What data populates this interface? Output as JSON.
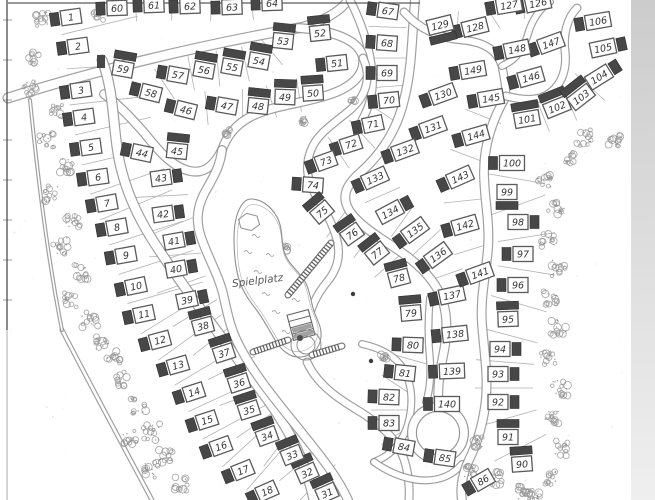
{
  "map": {
    "playground_label": "Spielplatz",
    "colors": {
      "ink": "#8f8f8f",
      "border": "#3d3d3d",
      "building": "#474747",
      "box_border": "#5a5a5a",
      "number": "#333333",
      "parcel_line": "#b3b3b3",
      "tree": "#929292",
      "edge_strip_top": "#cccccc",
      "edge_strip_bottom": "#efefef",
      "label_text": "#5a5a5a"
    },
    "lots": [
      [
        1,
        71,
        17,
        -8,
        "l"
      ],
      [
        2,
        78,
        46,
        -8,
        "l"
      ],
      [
        3,
        81,
        90,
        -8,
        "l"
      ],
      [
        4,
        84,
        117,
        -8,
        "l"
      ],
      [
        5,
        91,
        147,
        -8,
        "l"
      ],
      [
        6,
        98,
        177,
        -8,
        "l"
      ],
      [
        7,
        107,
        203,
        -10,
        "l"
      ],
      [
        8,
        117,
        227,
        -10,
        "l"
      ],
      [
        9,
        126,
        255,
        -10,
        "l"
      ],
      [
        10,
        136,
        286,
        -12,
        "l"
      ],
      [
        11,
        144,
        314,
        -12,
        "l"
      ],
      [
        12,
        160,
        340,
        -15,
        "l"
      ],
      [
        13,
        178,
        365,
        -16,
        "l"
      ],
      [
        14,
        194,
        392,
        -18,
        "l"
      ],
      [
        15,
        207,
        420,
        -18,
        "l"
      ],
      [
        16,
        221,
        446,
        -20,
        "l"
      ],
      [
        17,
        243,
        470,
        -22,
        "l"
      ],
      [
        18,
        267,
        491,
        -24,
        "l"
      ],
      [
        31,
        327,
        493,
        -24,
        "t"
      ],
      [
        32,
        307,
        473,
        -24,
        "t"
      ],
      [
        33,
        292,
        455,
        -22,
        "t"
      ],
      [
        34,
        267,
        436,
        -20,
        "t"
      ],
      [
        35,
        249,
        410,
        -18,
        "t"
      ],
      [
        36,
        239,
        383,
        -18,
        "t"
      ],
      [
        37,
        224,
        353,
        -18,
        "t"
      ],
      [
        38,
        203,
        326,
        -15,
        "t"
      ],
      [
        39,
        187,
        300,
        -12,
        "r"
      ],
      [
        40,
        176,
        269,
        -10,
        "r"
      ],
      [
        41,
        174,
        241,
        -10,
        "r"
      ],
      [
        42,
        163,
        214,
        -8,
        "r"
      ],
      [
        43,
        161,
        178,
        -8,
        "r"
      ],
      [
        44,
        142,
        153,
        12,
        "l"
      ],
      [
        45,
        177,
        151,
        6,
        "t"
      ],
      [
        46,
        186,
        110,
        14,
        "l"
      ],
      [
        47,
        227,
        106,
        10,
        "l"
      ],
      [
        48,
        258,
        106,
        6,
        "t"
      ],
      [
        49,
        285,
        97,
        2,
        "t"
      ],
      [
        50,
        313,
        93,
        -4,
        "t"
      ],
      [
        51,
        337,
        63,
        -6,
        "l"
      ],
      [
        52,
        320,
        33,
        -6,
        "t"
      ],
      [
        53,
        283,
        41,
        6,
        "t"
      ],
      [
        54,
        259,
        61,
        10,
        "t"
      ],
      [
        55,
        232,
        67,
        10,
        "t"
      ],
      [
        56,
        204,
        70,
        10,
        "t"
      ],
      [
        57,
        178,
        75,
        10,
        "l"
      ],
      [
        58,
        151,
        93,
        14,
        "l"
      ],
      [
        59,
        123,
        69,
        10,
        "t"
      ],
      [
        60,
        117,
        8,
        -2,
        "l"
      ],
      [
        61,
        154,
        5,
        -2,
        "l"
      ],
      [
        62,
        190,
        6,
        -2,
        "l"
      ],
      [
        63,
        232,
        7,
        -2,
        "l"
      ],
      [
        64,
        272,
        3,
        -2,
        "l"
      ],
      [
        67,
        388,
        11,
        8,
        "l"
      ],
      [
        68,
        387,
        43,
        4,
        "l"
      ],
      [
        69,
        387,
        73,
        0,
        "l"
      ],
      [
        70,
        389,
        100,
        -6,
        "l"
      ],
      [
        71,
        373,
        124,
        -12,
        "l"
      ],
      [
        72,
        351,
        144,
        -18,
        "l"
      ],
      [
        73,
        326,
        161,
        -20,
        "l"
      ],
      [
        74,
        313,
        185,
        4,
        "l"
      ],
      [
        75,
        322,
        212,
        -40,
        "t"
      ],
      [
        76,
        352,
        234,
        -35,
        "t"
      ],
      [
        77,
        377,
        253,
        -38,
        "t"
      ],
      [
        78,
        399,
        278,
        -15,
        "t"
      ],
      [
        79,
        411,
        313,
        -5,
        "t"
      ],
      [
        80,
        413,
        345,
        2,
        "l"
      ],
      [
        81,
        405,
        373,
        6,
        "l"
      ],
      [
        82,
        389,
        397,
        2,
        "l"
      ],
      [
        83,
        389,
        423,
        0,
        "l"
      ],
      [
        84,
        404,
        447,
        10,
        "l"
      ],
      [
        85,
        445,
        458,
        8,
        "l"
      ],
      [
        86,
        483,
        480,
        -30,
        "l"
      ],
      [
        90,
        522,
        464,
        -4,
        "t"
      ],
      [
        91,
        508,
        437,
        0,
        "t"
      ],
      [
        92,
        498,
        402,
        0,
        "r"
      ],
      [
        93,
        498,
        374,
        0,
        "r"
      ],
      [
        94,
        500,
        349,
        0,
        "r"
      ],
      [
        95,
        508,
        319,
        -2,
        "t"
      ],
      [
        96,
        518,
        285,
        0,
        "l"
      ],
      [
        97,
        523,
        254,
        0,
        "l"
      ],
      [
        98,
        518,
        222,
        0,
        "r"
      ],
      [
        99,
        507,
        192,
        0,
        "b"
      ],
      [
        100,
        512,
        163,
        0,
        "l"
      ],
      [
        101,
        527,
        119,
        -10,
        "t"
      ],
      [
        102,
        557,
        107,
        -22,
        "t"
      ],
      [
        103,
        581,
        97,
        -38,
        "t"
      ],
      [
        104,
        599,
        77,
        -32,
        "r"
      ],
      [
        105,
        603,
        48,
        -12,
        "r"
      ],
      [
        106,
        598,
        21,
        -10,
        "l"
      ],
      [
        126,
        538,
        3,
        -12,
        "l"
      ],
      [
        127,
        509,
        5,
        -10,
        "l"
      ],
      [
        128,
        475,
        27,
        -14,
        "l"
      ],
      [
        129,
        440,
        25,
        -14,
        "b"
      ],
      [
        130,
        443,
        94,
        -20,
        "l"
      ],
      [
        131,
        433,
        127,
        -20,
        "l"
      ],
      [
        132,
        405,
        150,
        -20,
        "l"
      ],
      [
        133,
        375,
        178,
        -24,
        "l"
      ],
      [
        134,
        390,
        212,
        -28,
        "r"
      ],
      [
        135,
        415,
        230,
        -36,
        "l"
      ],
      [
        136,
        438,
        255,
        -36,
        "l"
      ],
      [
        137,
        452,
        295,
        -12,
        "l"
      ],
      [
        138,
        455,
        334,
        -6,
        "l"
      ],
      [
        139,
        452,
        371,
        -2,
        "l"
      ],
      [
        140,
        447,
        404,
        0,
        "l"
      ],
      [
        141,
        480,
        273,
        -20,
        "l"
      ],
      [
        142,
        465,
        225,
        -16,
        "l"
      ],
      [
        143,
        460,
        177,
        -24,
        "l"
      ],
      [
        144,
        476,
        135,
        -16,
        "l"
      ],
      [
        145,
        491,
        98,
        -10,
        "l"
      ],
      [
        146,
        531,
        77,
        -16,
        "l"
      ],
      [
        147,
        551,
        43,
        -20,
        "l"
      ],
      [
        148,
        517,
        49,
        -12,
        "l"
      ],
      [
        149,
        473,
        70,
        -10,
        "l"
      ]
    ],
    "roads": [
      {
        "d": "M 8 98 C 90 72 200 45 298 28",
        "w": 11
      },
      {
        "d": "M 298 28 C 322 22 340 12 348 0",
        "w": 10
      },
      {
        "d": "M 350 0 C 362 24 370 48 372 72 C 374 90 370 106 362 120",
        "w": 9
      },
      {
        "d": "M 298 28 C 332 30 360 40 363 58 C 365 76 350 88 328 95 C 300 104 272 106 252 116 C 234 125 226 138 222 150 C 214 166 204 174 190 171 C 172 167 158 150 146 135 C 134 121 118 104 104 94",
        "w": 10
      },
      {
        "d": "M 102 60 C 116 96 112 136 122 172 C 134 218 160 252 184 286 C 208 320 236 356 262 392 C 286 424 304 456 314 500",
        "w": 11
      },
      {
        "d": "M 222 150 C 220 168 211 181 204 194 C 196 210 196 224 202 240 C 210 262 220 278 224 298 C 228 316 231 331 241 349 C 257 379 283 409 306 438 C 322 458 338 478 348 500",
        "w": 10
      },
      {
        "d": "M 363 58 C 372 78 366 96 350 110 C 333 124 317 134 311 150 C 305 165 307 180 315 194 C 325 210 333 224 337 240 C 341 256 337 270 327 282 C 317 294 310 308 307 326",
        "w": 9
      },
      {
        "d": "M 415 0 C 412 35 412 70 404 100 C 397 130 381 154 361 172 C 346 185 341 196 349 210 C 359 226 381 238 401 252 C 421 266 437 282 443 302 C 448 318 447 338 443 356 C 439 376 437 392 439 408",
        "w": 10
      },
      {
        "d": "M 307 362 C 316 382 334 396 354 408 C 374 420 390 432 399 448 C 407 462 410 482 409 500",
        "w": 9
      },
      {
        "d": "M 362 344 C 380 348 396 356 404 370 C 413 386 413 406 408 424 C 402 444 390 456 374 462",
        "w": 8
      },
      {
        "d": "M 374 462 C 388 472 402 478 418 480 C 438 482 452 476 462 464",
        "w": 8
      },
      {
        "d": "M 506 96 C 492 120 484 146 484 172 C 484 198 490 222 488 248 C 486 274 480 298 482 324 C 484 350 488 374 486 398 C 484 420 478 442 468 462 C 462 476 460 488 462 500",
        "w": 10
      },
      {
        "d": "M 404 12 C 420 30 440 38 462 40 C 486 42 498 52 502 66 C 504 76 506 88 506 96",
        "w": 9
      },
      {
        "d": "M 502 66 C 516 60 524 48 528 34 C 532 20 540 8 550 2",
        "w": 8
      },
      {
        "d": "M 506 96 C 522 100 538 102 550 93 C 563 83 567 67 565 51 C 563 35 567 18 577 8",
        "w": 9
      },
      {
        "d": "M 430 298 C 428 318 428 340 430 360 C 431 376 430 390 426 402",
        "w": 8
      },
      {
        "d": "M 62 330 C 92 388 122 444 152 500",
        "w": 5
      },
      {
        "d": "M 30 100 C 38 180 48 260 62 330",
        "w": 4
      }
    ],
    "borders": [
      {
        "d": "M 8 3 L 420 3",
        "sw": 1.3,
        "op": 0.85
      },
      {
        "d": "M 7 0 L 7 330",
        "sw": 1.3,
        "op": 0.9
      },
      {
        "d": "M 7 330 L 7 500",
        "sw": 1.1,
        "op": 0.4
      },
      {
        "d": "M 632 0 L 632 256",
        "sw": 1.6,
        "op": 0.95
      }
    ],
    "border_ticks": [
      20,
      60,
      100,
      140,
      180,
      220,
      260,
      300
    ],
    "trees": [
      [
        40,
        18,
        8
      ],
      [
        98,
        13,
        7
      ],
      [
        34,
        58,
        6
      ],
      [
        30,
        88,
        7
      ],
      [
        58,
        112,
        7
      ],
      [
        46,
        140,
        8
      ],
      [
        66,
        166,
        7
      ],
      [
        52,
        194,
        8
      ],
      [
        73,
        220,
        7
      ],
      [
        60,
        246,
        8
      ],
      [
        82,
        272,
        8
      ],
      [
        70,
        300,
        7
      ],
      [
        90,
        320,
        8
      ],
      [
        102,
        342,
        7
      ],
      [
        114,
        356,
        7
      ],
      [
        124,
        380,
        8
      ],
      [
        138,
        406,
        8
      ],
      [
        152,
        432,
        9
      ],
      [
        166,
        456,
        8
      ],
      [
        130,
        436,
        8
      ],
      [
        150,
        470,
        8
      ],
      [
        180,
        484,
        7
      ],
      [
        545,
        182,
        7
      ],
      [
        556,
        210,
        8
      ],
      [
        547,
        240,
        7
      ],
      [
        559,
        268,
        8
      ],
      [
        550,
        298,
        7
      ],
      [
        558,
        328,
        8
      ],
      [
        548,
        358,
        7
      ],
      [
        560,
        388,
        8
      ],
      [
        552,
        418,
        7
      ],
      [
        561,
        448,
        8
      ],
      [
        550,
        478,
        7
      ],
      [
        534,
        496,
        6
      ],
      [
        585,
        138,
        8
      ],
      [
        614,
        142,
        7
      ],
      [
        644,
        130,
        6
      ],
      [
        568,
        158,
        6
      ],
      [
        498,
        478,
        8
      ],
      [
        522,
        492,
        7
      ],
      [
        476,
        442,
        6
      ],
      [
        470,
        472,
        6
      ],
      [
        302,
        120,
        4
      ],
      [
        228,
        132,
        3
      ],
      [
        385,
        357,
        4
      ],
      [
        352,
        100,
        3
      ],
      [
        260,
        212,
        3
      ],
      [
        285,
        248,
        3
      ]
    ],
    "parcel_groups": [
      {
        "nums": [
          1,
          2,
          3,
          4,
          5,
          6,
          7,
          8,
          9,
          10,
          11,
          12,
          13,
          14,
          15,
          16,
          17,
          18
        ],
        "len": 78,
        "off": -26
      },
      {
        "nums": [
          43,
          42,
          41,
          40,
          39,
          38,
          37,
          36,
          35,
          34,
          33,
          32,
          31
        ],
        "len": 52,
        "off": 0
      },
      {
        "nums": [
          60,
          61,
          62,
          63,
          64
        ],
        "len": 30,
        "off": 0
      },
      {
        "nums": [
          67,
          68,
          69,
          70,
          71,
          72,
          73
        ],
        "len": 38,
        "off": 0
      },
      {
        "nums": [
          53,
          54,
          55,
          56,
          57,
          58
        ],
        "len": 36,
        "off": 0
      },
      {
        "nums": [
          46,
          47,
          48,
          49,
          50
        ],
        "len": 34,
        "off": 0
      },
      {
        "nums": [
          75,
          76,
          77,
          78
        ],
        "len": 36,
        "off": 0
      },
      {
        "nums": [
          90,
          91,
          92,
          93,
          94,
          95,
          96,
          97,
          98,
          99,
          100
        ],
        "len": 58,
        "off": 6
      },
      {
        "nums": [
          101,
          102,
          103,
          104
        ],
        "len": 40,
        "off": 0
      },
      {
        "nums": [
          133,
          134,
          135,
          136,
          137
        ],
        "len": 38,
        "off": 0
      },
      {
        "nums": [
          141,
          142,
          143,
          144,
          145
        ],
        "len": 38,
        "off": 0
      },
      {
        "nums": [
          80,
          81,
          82,
          83,
          84
        ],
        "len": 36,
        "off": 0
      },
      {
        "nums": [
          126,
          127,
          128,
          129
        ],
        "len": 30,
        "off": 0
      }
    ],
    "features": {
      "island_outline": "M 251 199 C 261 199 271 206 277 217 C 283 228 281 240 284 251 C 287 262 295 268 302 277 C 309 286 310 297 313 308 C 316 319 322 326 321 337 C 320 348 312 356 301 357 C 290 358 281 350 275 340 C 269 330 263 318 255 308 C 247 298 241 288 238 276 C 235 264 234 251 234 239 C 234 227 236 214 241 206 C 244 201 247 199 251 199 Z",
      "pond": {
        "cx": 249,
        "cy": 222,
        "r": 11
      },
      "kiosk": {
        "x": 301,
        "y": 325,
        "w": 22,
        "h": 26,
        "rot": -15,
        "bands": 4
      },
      "rings": {
        "cx": 306,
        "cy": 345,
        "radii": [
          15,
          9
        ],
        "dot": [
          300,
          338
        ]
      },
      "roundabout": {
        "cx": 438,
        "cy": 433,
        "r": 26,
        "w": 10
      },
      "ladders": [
        [
          288,
          295,
          331,
          243
        ],
        [
          253,
          352,
          288,
          340
        ],
        [
          312,
          355,
          342,
          346
        ]
      ],
      "scribbles": [
        [
          248,
          252
        ],
        [
          258,
          272
        ],
        [
          266,
          294
        ],
        [
          276,
          312
        ],
        [
          286,
          332
        ],
        [
          256,
          236
        ],
        [
          296,
          300
        ],
        [
          305,
          316
        ],
        [
          270,
          255
        ]
      ],
      "junction_block": {
        "x": 97,
        "y": 55,
        "w": 8,
        "h": 13
      },
      "dots": [
        [
          353,
          294
        ],
        [
          371,
          361
        ]
      ]
    },
    "edge_strip": {
      "x": 631,
      "w": 24
    }
  }
}
